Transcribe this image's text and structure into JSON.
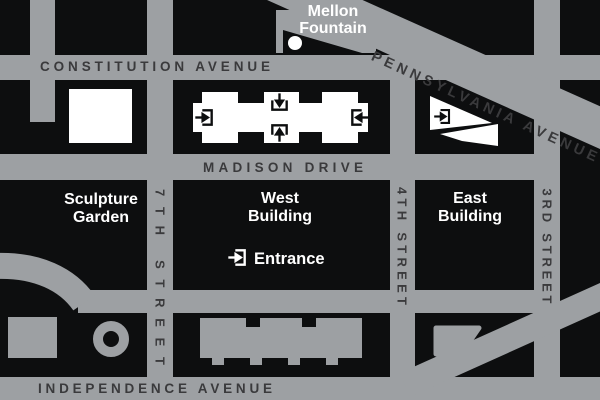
{
  "map": {
    "title": "National Gallery of Art area map",
    "colors": {
      "street_gray": "#9DA0A3",
      "block_black": "#0D0E0F",
      "street_text": "#3A3A3C",
      "building_white": "#FFFFFF"
    },
    "streets": {
      "constitution": "CONSTITUTION AVENUE",
      "pennsylvania": "PENNSYLVANIA AVENUE",
      "madison": "MADISON DRIVE",
      "independence": "INDEPENDENCE AVENUE",
      "seventh": "7TH STREET",
      "fourth": "4TH STREET",
      "third": "3RD STREET"
    },
    "places": {
      "mellon_line1": "Mellon",
      "mellon_line2": "Fountain",
      "sculpture_line1": "Sculpture",
      "sculpture_line2": "Garden",
      "west_line1": "West",
      "west_line2": "Building",
      "east_line1": "East",
      "east_line2": "Building",
      "entrance": "Entrance"
    },
    "icons": {
      "entrance_arrow": "entrance-arrow-icon",
      "fountain_dot": "mellon-fountain-dot"
    }
  }
}
